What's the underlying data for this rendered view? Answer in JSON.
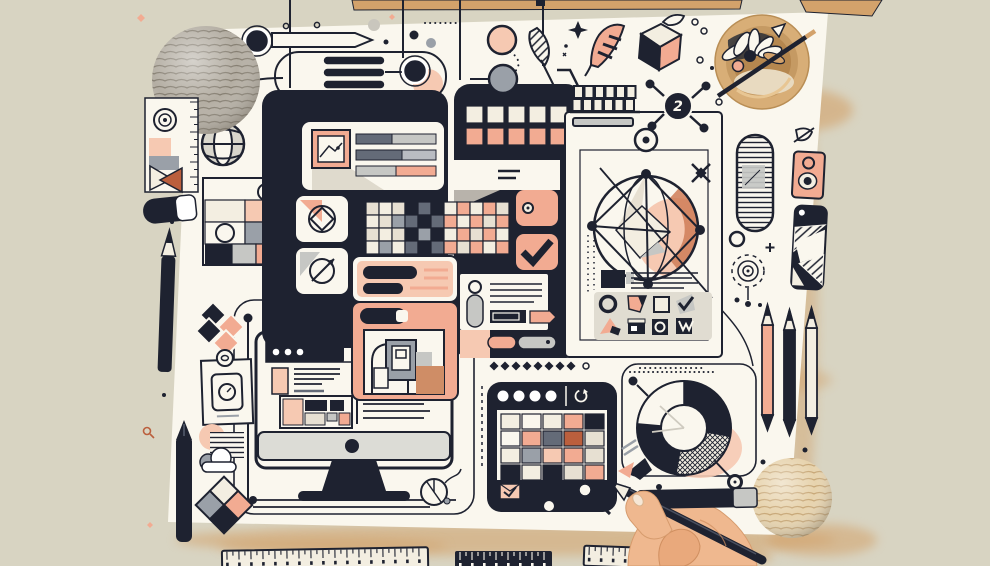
{
  "scene": {
    "title": "Flat-lay illustration: web design planning collage",
    "hub_badge": "2"
  },
  "colors": {
    "bg": "#d8d4c2",
    "canvas": "#faf7ee",
    "cream": "#f3eee1",
    "beige": "#e7e0d2",
    "ink": "#1e2230",
    "slate": "#646b78",
    "grey": "#9aa0a8",
    "grey_light": "#c6c7c4",
    "peach": "#f2ab92",
    "peach_light": "#f6c9b2",
    "terracotta": "#bb5f3d",
    "tan": "#d3a26b",
    "wood": "#c9995f",
    "skin": "#efb88f",
    "yarn_grey": "#b4aea3",
    "yarn_beige": "#e7d3ad"
  },
  "grids": {
    "panel_c_top": {
      "x": 466,
      "y": 106,
      "cw": 17,
      "ch": 17,
      "gx": 4,
      "gy": 5,
      "stroke": "ink",
      "cells": [
        [
          "cream",
          "cream",
          "cream",
          "cream",
          "cream"
        ],
        [
          "peach",
          "peach",
          "peach",
          "peach",
          "peach"
        ]
      ]
    },
    "swatch_strip": {
      "x": 366,
      "y": 202,
      "cw": 13,
      "ch": 13,
      "gx": 0,
      "gy": 0,
      "stroke": "ink",
      "cells": [
        [
          "beige",
          "cream",
          "beige",
          "ink",
          "slate",
          "ink",
          "cream",
          "peach",
          "cream",
          "peach",
          "beige"
        ],
        [
          "cream",
          "beige",
          "grey",
          "slate",
          "ink",
          "slate",
          "peach",
          "cream",
          "peach",
          "beige",
          "peach"
        ],
        [
          "beige",
          "cream",
          "beige",
          "ink",
          "grey",
          "ink",
          "cream",
          "peach",
          "beige",
          "peach",
          "cream"
        ],
        [
          "cream",
          "grey",
          "cream",
          "slate",
          "ink",
          "slate",
          "peach",
          "beige",
          "peach",
          "cream",
          "peach"
        ]
      ]
    },
    "palette_grid": {
      "x": 501,
      "y": 414,
      "cw": 19,
      "ch": 15,
      "gx": 2,
      "gy": 2,
      "stroke": "ink",
      "cells": [
        [
          "cream",
          "canvas",
          "cream",
          "peach",
          "ink"
        ],
        [
          "canvas",
          "peach",
          "slate",
          "terracotta",
          "beige"
        ],
        [
          "cream",
          "grey",
          "peach_light",
          "peach",
          "beige"
        ],
        [
          "ink",
          "cream",
          "ink",
          "beige",
          "peach"
        ]
      ]
    }
  }
}
